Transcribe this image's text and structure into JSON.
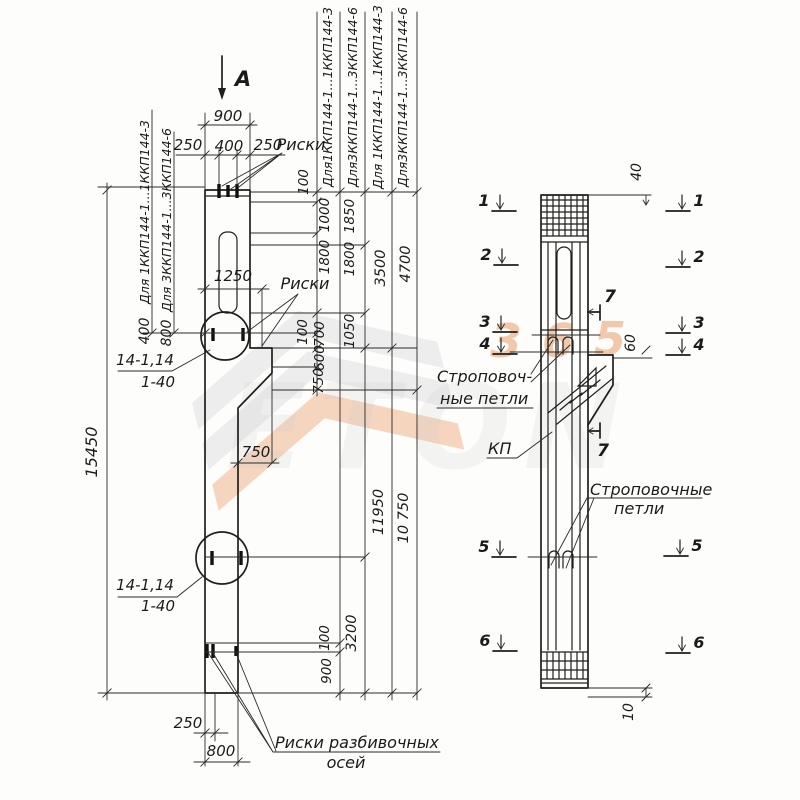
{
  "palette": {
    "ink": "#1f1f1f",
    "paper": "#fdfdfc",
    "wm_orange": "#e8945a",
    "wm_gray": "#c9c9c9"
  },
  "watermark": {
    "brand": "ETON",
    "digits": [
      "3",
      "6",
      "5"
    ]
  },
  "labels": [
    {
      "n": "view-direction-label",
      "t": "А",
      "x": 243,
      "y": 86,
      "s": 21,
      "w": "bold"
    },
    {
      "n": "dim-top-900",
      "t": "900",
      "x": 228,
      "y": 121,
      "s": 15
    },
    {
      "n": "dim-top-250-left",
      "t": "250",
      "x": 188,
      "y": 150,
      "s": 15
    },
    {
      "n": "dim-top-400",
      "t": "400",
      "x": 229,
      "y": 151,
      "s": 15
    },
    {
      "n": "dim-top-250-right",
      "t": "250",
      "x": 268,
      "y": 150,
      "s": 15
    },
    {
      "n": "label-riski-top",
      "t": "Риски",
      "x": 301,
      "y": 150,
      "s": 16
    },
    {
      "n": "left-guideline-1-label",
      "t": "Для 1ККП144-1...1ККП144-3",
      "x": 149,
      "y": 212,
      "r": -90,
      "s": 12.5
    },
    {
      "n": "left-guideline-1-value",
      "t": "400",
      "x": 149,
      "y": 331,
      "r": -90,
      "s": 14
    },
    {
      "n": "left-guideline-2-label",
      "t": "Для 3ККП144-1...3ККП144-6",
      "x": 171,
      "y": 220,
      "r": -90,
      "s": 12.5
    },
    {
      "n": "left-guideline-2-value",
      "t": "800",
      "x": 171,
      "y": 333,
      "r": -90,
      "s": 14
    },
    {
      "n": "dim-overall-15450",
      "t": "15450",
      "x": 97,
      "y": 452,
      "r": -90,
      "s": 16
    },
    {
      "n": "dim-1250",
      "t": "1250",
      "x": 233,
      "y": 281,
      "s": 15
    },
    {
      "n": "label-riski-middle",
      "t": "Риски",
      "x": 305,
      "y": 289,
      "s": 16
    },
    {
      "n": "detail-1-mark",
      "t": "14-1,14",
      "x": 145,
      "y": 365,
      "s": 15
    },
    {
      "n": "detail-1-scale",
      "t": "1-40",
      "x": 158,
      "y": 387,
      "s": 15
    },
    {
      "n": "dim-console-750",
      "t": "750",
      "x": 256,
      "y": 457,
      "s": 15
    },
    {
      "n": "detail-2-mark",
      "t": "14-1,14",
      "x": 145,
      "y": 590,
      "s": 15
    },
    {
      "n": "detail-2-scale",
      "t": "1-40",
      "x": 158,
      "y": 611,
      "s": 15
    },
    {
      "n": "dim-bottom-250",
      "t": "250",
      "x": 188,
      "y": 728,
      "s": 15
    },
    {
      "n": "dim-bottom-800",
      "t": "800",
      "x": 221,
      "y": 756,
      "s": 15
    },
    {
      "n": "label-riski-axes-line1",
      "t": "Риски разбивочных",
      "x": 357,
      "y": 748,
      "s": 16
    },
    {
      "n": "label-riski-axes-line2",
      "t": "осей",
      "x": 346,
      "y": 768,
      "s": 16
    },
    {
      "n": "chain-label-1",
      "t": "Для1ККП144-1...1ККП144-3",
      "x": 332,
      "y": 97,
      "r": -90,
      "s": 12.5
    },
    {
      "n": "chain-label-2",
      "t": "Для3ККП144-1...3ККП144-6",
      "x": 357,
      "y": 97,
      "r": -90,
      "s": 12.5
    },
    {
      "n": "chain-label-3",
      "t": "Для 1ККП144-1...1ККП144-3",
      "x": 382,
      "y": 97,
      "r": -90,
      "s": 12.5
    },
    {
      "n": "chain-label-4",
      "t": "Для3ККП144-1...3ККП144-6",
      "x": 407,
      "y": 97,
      "r": -90,
      "s": 12.5
    },
    {
      "n": "dim-100-top",
      "t": "100",
      "x": 308,
      "y": 182,
      "r": -90,
      "s": 13.5
    },
    {
      "n": "dim-1000",
      "t": "1000",
      "x": 329,
      "y": 215,
      "r": -90,
      "s": 13.5
    },
    {
      "n": "dim-1850",
      "t": "1850",
      "x": 354,
      "y": 216,
      "r": -90,
      "s": 13.5
    },
    {
      "n": "dim-1800-a",
      "t": "1800",
      "x": 329,
      "y": 257,
      "r": -90,
      "s": 13.5
    },
    {
      "n": "dim-1800-b",
      "t": "1800",
      "x": 354,
      "y": 259,
      "r": -90,
      "s": 13.5
    },
    {
      "n": "dim-3500",
      "t": "3500",
      "x": 385,
      "y": 268,
      "r": -90,
      "s": 14.5
    },
    {
      "n": "dim-4700",
      "t": "4700",
      "x": 410,
      "y": 264,
      "r": -90,
      "s": 14.5
    },
    {
      "n": "dim-100-mid",
      "t": "100",
      "x": 307,
      "y": 332,
      "r": -90,
      "s": 13.5
    },
    {
      "n": "dim-700",
      "t": "700",
      "x": 324,
      "y": 334,
      "r": -90,
      "s": 13.5
    },
    {
      "n": "dim-1050",
      "t": "1050",
      "x": 354,
      "y": 331,
      "r": -90,
      "s": 13.5
    },
    {
      "n": "dim-600",
      "t": "600",
      "x": 324,
      "y": 358,
      "r": -90,
      "s": 13.5
    },
    {
      "n": "dim-750-chain",
      "t": "750",
      "x": 323,
      "y": 381,
      "r": -90,
      "s": 13.5
    },
    {
      "n": "dim-11950",
      "t": "11950",
      "x": 383,
      "y": 512,
      "r": -90,
      "s": 14.5
    },
    {
      "n": "dim-10750",
      "t": "10 750",
      "x": 408,
      "y": 518,
      "r": -90,
      "s": 14.5
    },
    {
      "n": "dim-3200",
      "t": "3200",
      "x": 356,
      "y": 633,
      "r": -90,
      "s": 14.5
    },
    {
      "n": "dim-100-bottom",
      "t": "100",
      "x": 329,
      "y": 638,
      "r": -90,
      "s": 13.5
    },
    {
      "n": "dim-900-bottom",
      "t": "900",
      "x": 331,
      "y": 671,
      "r": -90,
      "s": 13.5
    },
    {
      "n": "dim-40",
      "t": "40",
      "x": 641,
      "y": 172,
      "r": -90,
      "s": 14
    },
    {
      "n": "dim-60",
      "t": "60",
      "x": 635,
      "y": 343,
      "r": -90,
      "s": 14
    },
    {
      "n": "dim-10",
      "t": "10",
      "x": 633,
      "y": 712,
      "r": -90,
      "s": 14
    },
    {
      "n": "label-lifting-loops-1a",
      "t": "Строповоч-",
      "x": 437,
      "y": 382,
      "a": "start",
      "s": 16
    },
    {
      "n": "label-lifting-loops-1b",
      "t": "ные петли",
      "x": 440,
      "y": 404,
      "a": "start",
      "s": 16
    },
    {
      "n": "label-kp",
      "t": "КП",
      "x": 488,
      "y": 454,
      "a": "start",
      "s": 16
    },
    {
      "n": "label-lifting-loops-2a",
      "t": "Строповочные",
      "x": 590,
      "y": 495,
      "a": "start",
      "s": 16
    },
    {
      "n": "label-lifting-loops-2b",
      "t": "петли",
      "x": 614,
      "y": 514,
      "a": "start",
      "s": 16
    },
    {
      "n": "section-7-label-a",
      "t": "7",
      "x": 610,
      "y": 302,
      "s": 17,
      "w": "bold"
    },
    {
      "n": "section-7-label-b",
      "t": "7",
      "x": 603,
      "y": 456,
      "s": 17,
      "w": "bold"
    }
  ],
  "section_markers": [
    {
      "digit": "1",
      "side": "left",
      "x": 494,
      "y": 211
    },
    {
      "digit": "2",
      "side": "left",
      "x": 496,
      "y": 265
    },
    {
      "digit": "3",
      "side": "left",
      "x": 495,
      "y": 332
    },
    {
      "digit": "4",
      "side": "left",
      "x": 495,
      "y": 354
    },
    {
      "digit": "5",
      "side": "left",
      "x": 494,
      "y": 557
    },
    {
      "digit": "6",
      "side": "left",
      "x": 495,
      "y": 651
    },
    {
      "digit": "1",
      "side": "right",
      "x": 688,
      "y": 211
    },
    {
      "digit": "2",
      "side": "right",
      "x": 688,
      "y": 267
    },
    {
      "digit": "3",
      "side": "right",
      "x": 688,
      "y": 333
    },
    {
      "digit": "4",
      "side": "right",
      "x": 688,
      "y": 355
    },
    {
      "digit": "5",
      "side": "right",
      "x": 686,
      "y": 556
    },
    {
      "digit": "6",
      "side": "right",
      "x": 688,
      "y": 653
    }
  ]
}
